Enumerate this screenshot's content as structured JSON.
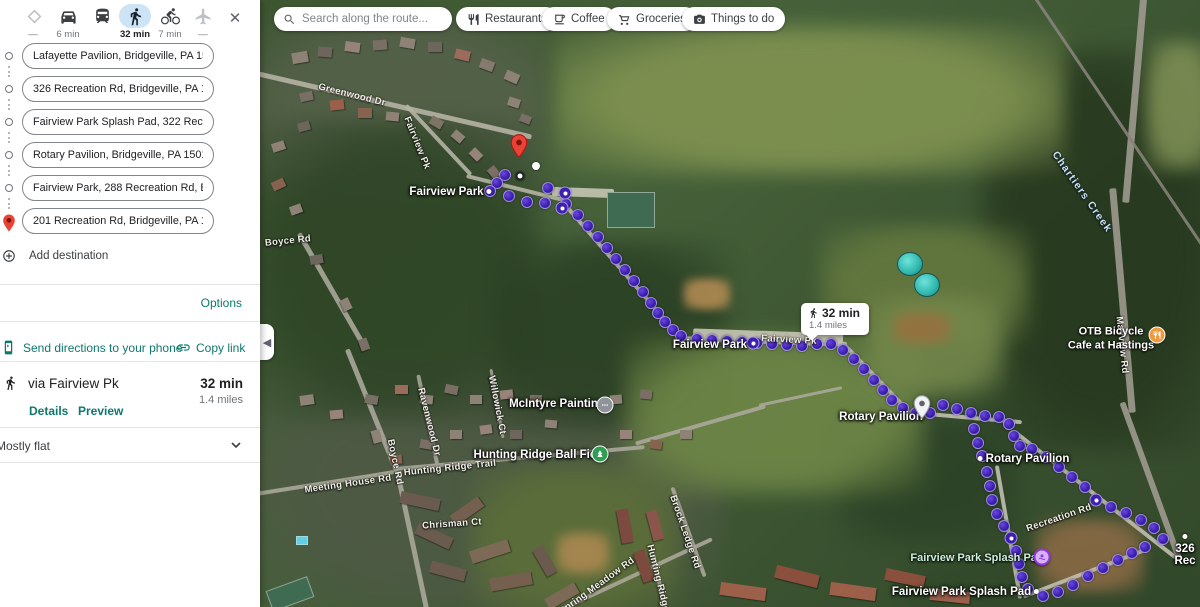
{
  "colors": {
    "accent_teal": "#0d796d",
    "selected_mode_pill": "#cde3f6",
    "route_dot": "#3d20b0",
    "start_pin_red": "#ea4335"
  },
  "sidebar": {
    "modes": [
      {
        "id": "best",
        "icon": "diamond-icon",
        "time": "—",
        "selected": false
      },
      {
        "id": "drive",
        "icon": "car-icon",
        "time": "6 min",
        "selected": false
      },
      {
        "id": "transit",
        "icon": "bus-icon",
        "time": "",
        "selected": false
      },
      {
        "id": "walk",
        "icon": "walk-icon",
        "time": "32 min",
        "selected": true
      },
      {
        "id": "bike",
        "icon": "bike-icon",
        "time": "7 min",
        "selected": false
      },
      {
        "id": "flight",
        "icon": "plane-icon",
        "time": "—",
        "selected": false
      }
    ],
    "stops": [
      "Lafayette Pavilion, Bridgeville, PA 15017",
      "326 Recreation Rd, Bridgeville, PA 15017",
      "Fairview Park Splash Pad, 322 Recreation",
      "Rotary Pavilion, Bridgeville, PA 15017",
      "Fairview Park, 288 Recreation Rd, Bridge",
      "201 Recreation Rd, Bridgeville, PA 15017"
    ],
    "add_destination": "Add destination",
    "options": "Options",
    "send_to_phone": "Send directions to your phone",
    "copy_link": "Copy link",
    "route_summary": {
      "via": "via Fairview Pk",
      "duration": "32 min",
      "distance": "1.4 miles",
      "details": "Details",
      "preview": "Preview"
    },
    "elevation": "Mostly flat"
  },
  "map": {
    "search_placeholder": "Search along the route...",
    "chips": [
      "Restaurants",
      "Coffee",
      "Groceries",
      "Things to do"
    ],
    "tooltip": {
      "duration": "32 min",
      "distance": "1.4 miles"
    },
    "labels": [
      {
        "t": "Greenwood Dr",
        "x": 352,
        "y": 95,
        "r": 14,
        "s": "road"
      },
      {
        "t": "Fairview Pk",
        "x": 417,
        "y": 143,
        "r": 68,
        "s": "road"
      },
      {
        "t": "Fairview Park",
        "x": 452,
        "y": 192,
        "r": 0,
        "s": "place",
        "dot": "right"
      },
      {
        "t": "Boyce Rd",
        "x": 288,
        "y": 241,
        "r": -6,
        "s": "road"
      },
      {
        "t": "Chartiers Creek",
        "x": 1082,
        "y": 192,
        "r": 55,
        "s": "creek"
      },
      {
        "t": "Fairview Park",
        "x": 710,
        "y": 345,
        "r": 0,
        "s": "place"
      },
      {
        "t": "Fairview Pk",
        "x": 789,
        "y": 340,
        "r": 3,
        "s": "road"
      },
      {
        "t": "Rotary Pavilion",
        "x": 881,
        "y": 417,
        "r": 0,
        "s": "place"
      },
      {
        "t": "Rotary Pavilion",
        "x": 1022,
        "y": 459,
        "r": 0,
        "s": "place",
        "dot": "left"
      },
      {
        "t": "McIntyre Painting",
        "x": 557,
        "y": 404,
        "r": 0,
        "s": "place"
      },
      {
        "t": "Hunting Ridge Ball Field",
        "x": 540,
        "y": 455,
        "r": 0,
        "s": "place"
      },
      {
        "t": "Hunting Ridge Trail",
        "x": 450,
        "y": 468,
        "r": -6,
        "s": "road"
      },
      {
        "t": "Meeting House Rd",
        "x": 348,
        "y": 484,
        "r": -8,
        "s": "road"
      },
      {
        "t": "Boyce Rd",
        "x": 395,
        "y": 462,
        "r": 78,
        "s": "road"
      },
      {
        "t": "Ravenwood Dr",
        "x": 429,
        "y": 422,
        "r": 76,
        "s": "road"
      },
      {
        "t": "Willowick Ct",
        "x": 497,
        "y": 405,
        "r": 79,
        "s": "road"
      },
      {
        "t": "Chrisman Ct",
        "x": 452,
        "y": 524,
        "r": -4,
        "s": "road"
      },
      {
        "t": "Brock Ledge Rd",
        "x": 685,
        "y": 532,
        "r": 71,
        "s": "road"
      },
      {
        "t": "Spring Meadow Rd",
        "x": 597,
        "y": 586,
        "r": -36,
        "s": "road"
      },
      {
        "t": "Hunting Ridge Rd",
        "x": 660,
        "y": 586,
        "r": 76,
        "s": "road"
      },
      {
        "t": "Recreation Rd",
        "x": 1059,
        "y": 518,
        "r": -19,
        "s": "road"
      },
      {
        "t": "Mayview Rd",
        "x": 1122,
        "y": 345,
        "r": 84,
        "s": "road"
      },
      {
        "t": "Fairview Park Splash Pad",
        "x": 977,
        "y": 558,
        "r": 0,
        "s": "park"
      },
      {
        "t": "Fairview Park Splash Pad",
        "x": 967,
        "y": 592,
        "r": 0,
        "s": "place",
        "dot": "right"
      },
      {
        "t": "326 Rec",
        "x": 1185,
        "y": 549,
        "r": 0,
        "s": "place",
        "dot": "left"
      },
      {
        "t": "OTB Bicycle\nCafe at Hastings",
        "x": 1111,
        "y": 339,
        "r": 0,
        "s": "place2"
      }
    ],
    "route": {
      "segments": [
        [
          [
            505,
            175
          ],
          [
            497,
            183
          ],
          [
            490,
            191
          ],
          [
            509,
            196
          ],
          [
            527,
            202
          ],
          [
            545,
            203
          ],
          [
            548,
            188
          ],
          [
            565,
            193
          ],
          [
            566,
            204
          ],
          [
            562,
            208
          ]
        ],
        [
          [
            578,
            215
          ],
          [
            588,
            226
          ],
          [
            598,
            237
          ],
          [
            607,
            248
          ],
          [
            616,
            259
          ],
          [
            625,
            270
          ],
          [
            634,
            281
          ],
          [
            643,
            292
          ],
          [
            651,
            303
          ],
          [
            658,
            313
          ],
          [
            665,
            322
          ],
          [
            673,
            330
          ],
          [
            681,
            336
          ]
        ],
        [
          [
            697,
            339
          ],
          [
            712,
            340
          ],
          [
            727,
            341
          ],
          [
            742,
            342
          ],
          [
            757,
            343
          ],
          [
            772,
            344
          ],
          [
            787,
            345
          ],
          [
            802,
            346
          ],
          [
            817,
            344
          ],
          [
            831,
            344
          ]
        ],
        [
          [
            843,
            350
          ],
          [
            854,
            359
          ],
          [
            864,
            369
          ],
          [
            874,
            380
          ],
          [
            883,
            390
          ],
          [
            892,
            400
          ],
          [
            903,
            408
          ],
          [
            916,
            413
          ]
        ],
        [
          [
            930,
            413
          ],
          [
            943,
            405
          ],
          [
            957,
            409
          ],
          [
            971,
            413
          ],
          [
            985,
            416
          ],
          [
            999,
            417
          ],
          [
            1009,
            424
          ],
          [
            1014,
            436
          ],
          [
            1020,
            446
          ]
        ],
        [
          [
            974,
            429
          ],
          [
            978,
            443
          ],
          [
            982,
            456
          ]
        ],
        [
          [
            1032,
            449
          ],
          [
            1046,
            457
          ],
          [
            1059,
            467
          ],
          [
            1072,
            477
          ],
          [
            1085,
            487
          ],
          [
            1096,
            500
          ],
          [
            1111,
            507
          ],
          [
            1126,
            513
          ],
          [
            1141,
            520
          ],
          [
            1154,
            528
          ],
          [
            1163,
            539
          ]
        ],
        [
          [
            987,
            472
          ],
          [
            990,
            486
          ],
          [
            992,
            500
          ],
          [
            997,
            514
          ],
          [
            1004,
            526
          ],
          [
            1011,
            538
          ],
          [
            1016,
            551
          ],
          [
            1019,
            564
          ],
          [
            1022,
            577
          ],
          [
            1028,
            589
          ]
        ],
        [
          [
            1043,
            596
          ],
          [
            1058,
            592
          ],
          [
            1073,
            585
          ],
          [
            1088,
            576
          ],
          [
            1103,
            568
          ],
          [
            1118,
            560
          ],
          [
            1132,
            553
          ],
          [
            1145,
            547
          ]
        ]
      ],
      "waypoint_dots": [
        [
          565,
          193
        ],
        [
          562,
          208
        ],
        [
          753,
          343
        ],
        [
          1096,
          500
        ],
        [
          1011,
          538
        ]
      ]
    },
    "markers": [
      {
        "name": "start-pin",
        "type": "red-pin",
        "x": 519,
        "y": 163
      },
      {
        "name": "rotary-pavilion-pin",
        "type": "white-pin",
        "x": 922,
        "y": 414
      },
      {
        "name": "waypoint-white-dot",
        "type": "white-dot",
        "x": 536,
        "y": 166
      },
      {
        "name": "origin-ring-dot",
        "type": "ring-dot",
        "x": 520,
        "y": 176
      },
      {
        "name": "splash-pad-poi",
        "type": "splash",
        "x": 1042,
        "y": 557
      },
      {
        "name": "otb-cafe-poi",
        "type": "restaurant",
        "x": 1157,
        "y": 335,
        "color": "#ef9a3d"
      },
      {
        "name": "mcintyre-painting-poi",
        "type": "generic",
        "x": 605,
        "y": 405,
        "color": "#8e9499"
      },
      {
        "name": "ball-field-poi",
        "type": "park",
        "x": 600,
        "y": 454,
        "color": "#2f9e53"
      }
    ]
  }
}
